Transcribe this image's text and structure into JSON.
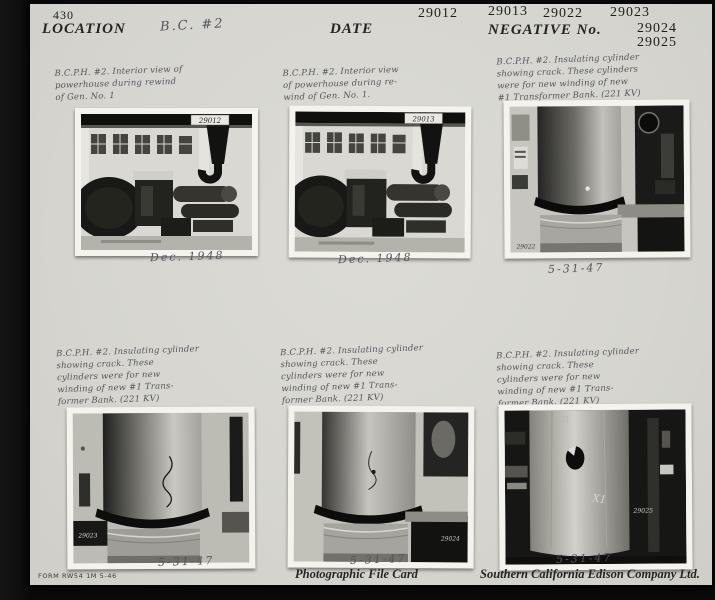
{
  "header": {
    "card_number": "430",
    "location_label": "LOCATION",
    "location_value": "B.C. #2",
    "date_label": "DATE",
    "negative_label": "NEGATIVE  No.",
    "negative_numbers": [
      "29012",
      "29013",
      "29022",
      "29023",
      "29024",
      "29025"
    ]
  },
  "photos": [
    {
      "caption": "B.C.P.H. #2. Interior view of\npowerhouse during rewind\nof Gen. No. 1",
      "negative_no": "29012",
      "date": "Dec. 1948"
    },
    {
      "caption": "B.C.P.H. #2. Interior view\nof powerhouse during re-\nwind of Gen. No. 1.",
      "negative_no": "29013",
      "date": "Dec. 1948"
    },
    {
      "caption": "B.C.P.H. #2. Insulating cylinder\nshowing crack. These cylinders\nwere for new winding of new\n#1 Transformer Bank. (221 KV)",
      "negative_no": "29022",
      "date": "5-31-47"
    },
    {
      "caption": "B.C.P.H. #2. Insulating cylinder\nshowing crack. These\ncylinders were for new\nwinding of new #1 Trans-\nformer Bank. (221 KV)",
      "negative_no": "29023",
      "date": "5-31-47"
    },
    {
      "caption": "B.C.P.H. #2. Insulating cylinder\nshowing crack. These\ncylinders were for new\nwinding of new #1 Trans-\nformer Bank. (221 KV)",
      "negative_no": "29024",
      "date": "5-31-47"
    },
    {
      "caption": "B.C.P.H. #2. Insulating cylinder\nshowing crack. These\ncylinders were for new\nwinding of new #1 Trans-\nformer Bank. (221 KV)",
      "negative_no": "29025",
      "date": "5-31-47"
    }
  ],
  "marks": {
    "photo6_chalk": "X1",
    "photo6_chalk2": "TB"
  },
  "footer": {
    "form_number": "FORM RW54  1M  5-46",
    "card_type": "Photographic  File  Card",
    "company": "Southern  California  Edison  Company  Ltd."
  },
  "colors": {
    "card_bg": "#d7d6d0",
    "mat_bg": "#0b0b0b",
    "photo_border": "#f4f3ee"
  }
}
